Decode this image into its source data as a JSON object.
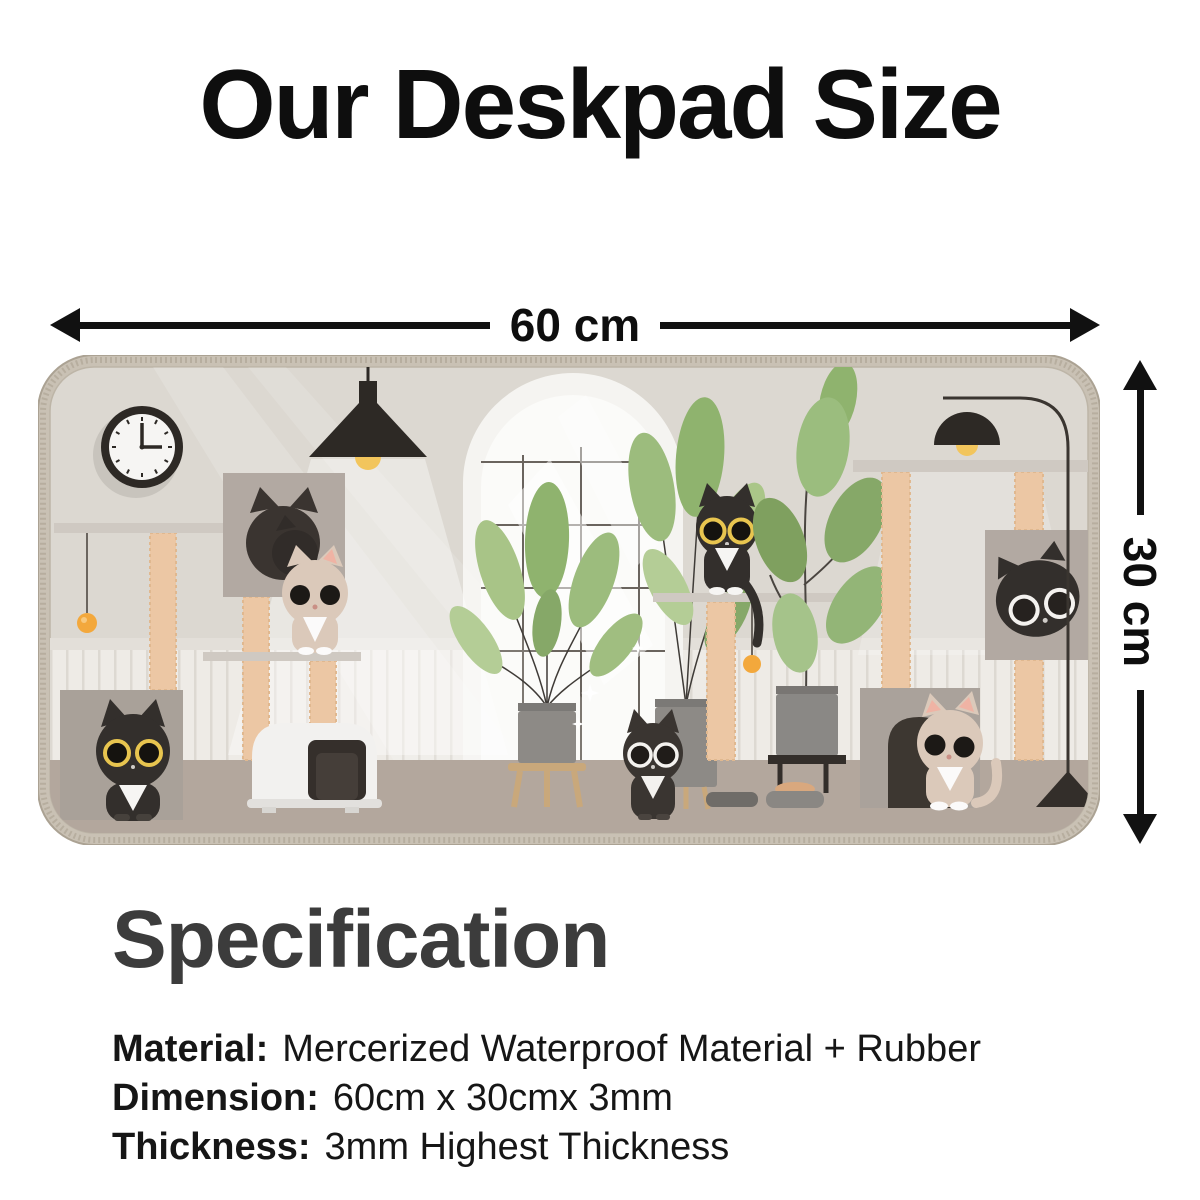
{
  "title": "Our Deskpad Size",
  "dimension_arrows": {
    "width_label": "60 cm",
    "height_label": "30 cm"
  },
  "specification": {
    "heading": "Specification",
    "items": [
      {
        "label": "Material:",
        "value": "Mercerized Waterproof Material + Rubber"
      },
      {
        "label": "Dimension:",
        "value": "60cm x 30cmx 3mm"
      },
      {
        "label": "Thickness:",
        "value": "3mm Highest Thickness"
      }
    ]
  },
  "deskpad_scene": {
    "alt": "Illustrated cat room deskpad with cats, cat trees, plants, arched window, lamps and a wall clock",
    "time_on_clock": "3:00",
    "colors": {
      "pad_edge": "#c9c1b4",
      "wall": "#dcd8d1",
      "wainscot": "#eeebe6",
      "floor": "#b3a79d",
      "cat_black": "#332f2c",
      "cat_cream": "#dbc9ba",
      "leaf_green": "#8fb36e",
      "post_tan": "#ecc7a4",
      "shelf_gray": "#cfc9c2",
      "toy_orange": "#f3a83c",
      "lamp_dark": "#2d2925",
      "eye_ring_yellow": "#e8c54f"
    },
    "elements": [
      "wall-clock",
      "pendant-lamp",
      "arched-window",
      "cat-tree-left",
      "sleeping-black-cat-in-cube",
      "cream-cat-on-shelf",
      "tuxedo-cat-in-cube",
      "litter-box",
      "potted-plant",
      "window-plant",
      "black-cat-on-shelf",
      "hanging-ball-toy",
      "rubber-plant",
      "black-cat-on-floor",
      "food-bowls",
      "cat-tree-right",
      "arc-floor-lamp",
      "black-cat-peeking-from-cube",
      "cream-cat-in-cube",
      "pennant-toy"
    ]
  }
}
